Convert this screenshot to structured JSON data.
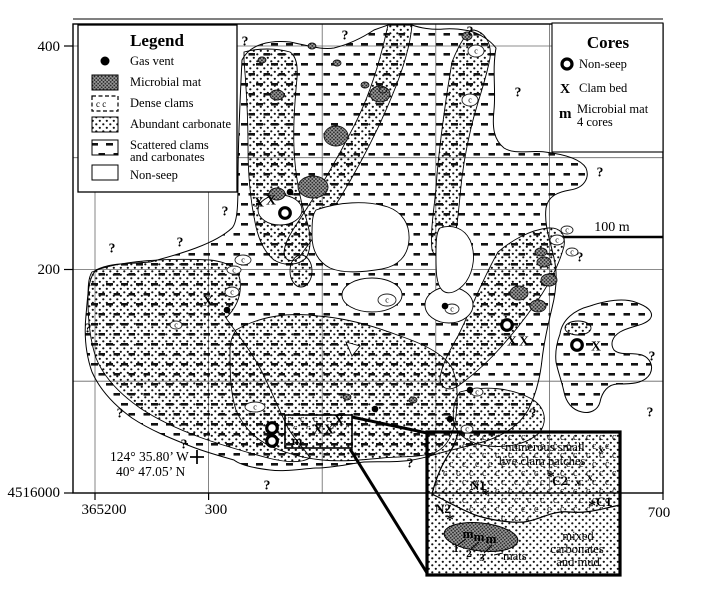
{
  "legend": {
    "title": "Legend",
    "items": [
      {
        "label": "Gas vent"
      },
      {
        "label": "Microbial mat"
      },
      {
        "label": "Dense clams"
      },
      {
        "label": "Abundant carbonate"
      },
      {
        "label": "Scattered clams",
        "label2": "and carbonates"
      },
      {
        "label": "Non-seep"
      }
    ]
  },
  "cores_legend": {
    "title": "Cores",
    "items": [
      {
        "symbol": "O",
        "label": "Non-seep"
      },
      {
        "symbol": "X",
        "label": "Clam bed"
      },
      {
        "symbol": "m",
        "label": "Microbial mat",
        "label2": "4 cores"
      }
    ]
  },
  "axes": {
    "y_labels": [
      {
        "text": "400"
      },
      {
        "text": "200"
      },
      {
        "text": "4516000"
      }
    ],
    "x_labels": [
      {
        "text": "365200"
      },
      {
        "text": "300"
      },
      {
        "text": "700"
      }
    ]
  },
  "scale_bar": {
    "label": "100 m"
  },
  "location": {
    "lon": "124° 35.80’ W",
    "lat": "40° 47.05’ N"
  },
  "inset": {
    "caption_line1": "numerous small",
    "caption_line2": "live clam patches",
    "zone_line1": "mixed",
    "zone_line2": "carbonates",
    "zone_line3": "and mud",
    "mats_label": "mats",
    "station_labels": [
      {
        "text": "N1",
        "x": 478,
        "y": 490
      },
      {
        "text": "N2",
        "x": 443,
        "y": 513
      },
      {
        "text": "C2",
        "x": 560,
        "y": 485
      },
      {
        "text": "C1",
        "x": 604,
        "y": 506
      }
    ],
    "numbers": [
      {
        "text": "1",
        "x": 456,
        "y": 552
      },
      {
        "text": "2",
        "x": 469,
        "y": 557
      },
      {
        "text": "3",
        "x": 482,
        "y": 561
      }
    ]
  },
  "symbols": {
    "question": "?",
    "clam_bed": "X",
    "mat_core": "m",
    "clam_letter": "c",
    "star": "*",
    "small_x": "x"
  },
  "markers": {
    "gas_vents": [
      [
        290,
        192
      ],
      [
        227,
        310
      ],
      [
        445,
        306
      ],
      [
        470,
        390
      ],
      [
        375,
        409
      ],
      [
        450,
        419
      ]
    ],
    "nonseep_cores": [
      [
        285,
        213
      ],
      [
        507,
        325
      ],
      [
        577,
        345
      ],
      [
        272,
        428
      ],
      [
        272,
        441
      ]
    ],
    "clam_bed_cores": [
      [
        259,
        202
      ],
      [
        271,
        200
      ],
      [
        208,
        301
      ],
      [
        512,
        341
      ],
      [
        524,
        341
      ],
      [
        596,
        346
      ],
      [
        318,
        429
      ],
      [
        329,
        429
      ],
      [
        339,
        420
      ]
    ],
    "mat_cores": [
      [
        297,
        441
      ],
      [
        468,
        534
      ],
      [
        479,
        537
      ],
      [
        491,
        539
      ]
    ],
    "question_marks": [
      [
        245,
        41
      ],
      [
        345,
        35
      ],
      [
        470,
        31
      ],
      [
        518,
        92
      ],
      [
        600,
        172
      ],
      [
        580,
        257
      ],
      [
        112,
        248
      ],
      [
        180,
        242
      ],
      [
        225,
        211
      ],
      [
        88,
        328
      ],
      [
        120,
        413
      ],
      [
        184,
        444
      ],
      [
        267,
        485
      ],
      [
        410,
        463
      ],
      [
        533,
        413
      ],
      [
        650,
        412
      ],
      [
        652,
        356
      ]
    ],
    "clam_patches": [
      [
        243,
        260,
        8,
        5
      ],
      [
        234,
        270,
        7,
        4
      ],
      [
        232,
        292,
        7,
        5
      ],
      [
        176,
        325,
        6,
        4
      ],
      [
        255,
        407,
        10,
        5
      ],
      [
        387,
        300,
        9,
        6
      ],
      [
        452,
        309,
        7,
        5
      ],
      [
        476,
        51,
        8,
        6
      ],
      [
        470,
        100,
        8,
        6
      ],
      [
        557,
        240,
        7,
        5
      ],
      [
        567,
        230,
        6,
        4
      ],
      [
        572,
        252,
        6,
        4
      ],
      [
        467,
        429,
        6,
        4
      ],
      [
        477,
        392,
        6,
        4
      ]
    ],
    "microbial_mats": [
      [
        313,
        187,
        15,
        11
      ],
      [
        336,
        136,
        12,
        10
      ],
      [
        380,
        94,
        10,
        8
      ],
      [
        277,
        194,
        8,
        6
      ],
      [
        277,
        95,
        7,
        5
      ],
      [
        312,
        46,
        4,
        3
      ],
      [
        337,
        63,
        4,
        3
      ],
      [
        365,
        85,
        4,
        3
      ],
      [
        383,
        90,
        4,
        3
      ],
      [
        467,
        36,
        5,
        4
      ],
      [
        519,
        293,
        9,
        7
      ],
      [
        538,
        306,
        8,
        6
      ],
      [
        549,
        280,
        8,
        6
      ],
      [
        544,
        262,
        7,
        5
      ],
      [
        541,
        252,
        6,
        4
      ],
      [
        347,
        397,
        4,
        3
      ],
      [
        413,
        400,
        4,
        3
      ],
      [
        262,
        60,
        4,
        3
      ]
    ],
    "inset_stars": [
      [
        486,
        494
      ],
      [
        450,
        519
      ],
      [
        592,
        505
      ],
      [
        551,
        476
      ]
    ],
    "inset_x": [
      [
        601,
        449
      ],
      [
        578,
        482
      ],
      [
        590,
        477
      ]
    ]
  }
}
